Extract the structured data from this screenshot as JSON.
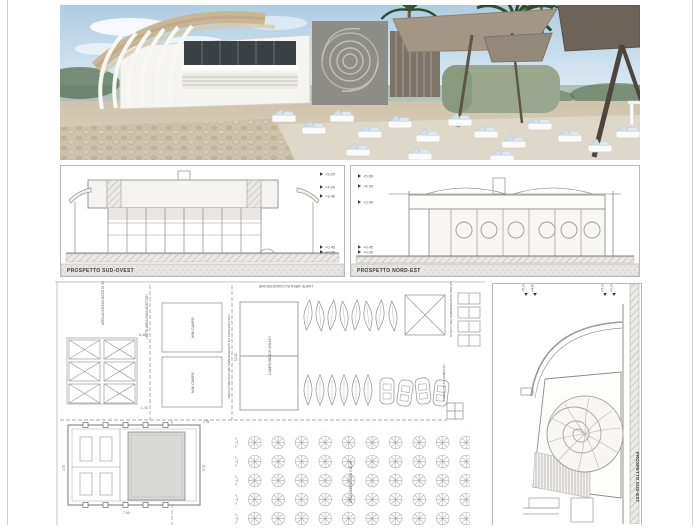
{
  "colors": {
    "linework": "#9a9a9a",
    "hatch": "#c8c8c8",
    "sky": "#b7d3e6",
    "sand": "#d0c5af",
    "umbrella": "#6e6358",
    "palm": "#2f4d2b",
    "cushion": "#d3e0ec",
    "roof_tan": "#c9b694",
    "green_wall": "#9aa78e"
  },
  "elevations": {
    "southwest": {
      "label": "PROSPETTO SUD-OVEST",
      "markers_top": [
        "+5.00",
        "+4.00",
        "+3.40"
      ],
      "markers_bottom": [
        "+0.45",
        "+0.00"
      ]
    },
    "northeast": {
      "label": "PROSPETTO NORD-EST",
      "markers_top": [
        "+5.00",
        "+4.50",
        "+3.40"
      ],
      "markers_bottom": [
        "+0.45",
        "+0.00"
      ]
    },
    "southeast": {
      "label": "PROSPETTO SUD-EST",
      "markers_left": [
        "+5.00",
        "+4.60"
      ],
      "markers_right": [
        "+5.00",
        "+0.00"
      ]
    }
  },
  "plan": {
    "labels": {
      "concession": "LIMITE AREA IN CONCESSIONE",
      "access": "AREA ACCESSO MEZZI DI SOCCORSO",
      "limit_left": "LIMITE AREA PIANI ADOTTATI",
      "mini_campo_1": "MINI CAMPO",
      "mini_campo_2": "MINI CAMPO",
      "equipment": "AREA ATTREZZATURE OMBREGGIANTI DA PIANI ADOTTATI",
      "volley": "CAMPO BEACH VOLLEY",
      "shade_structure": "STRUTTURA OMBREGGIANTE PER ATTIVITA' NAUTICHE",
      "lifeguard": "TORRETTA SALVAMENTO",
      "umbrellas": "AREA OMBRELLONI 5.00 ml",
      "limit_right": "LIMITE AREA PIANI ADOTTATI"
    },
    "dimensions": {
      "grid_width": "6.40",
      "grid_gap": "1.76",
      "volley_len": "12.45",
      "bldg_left": "4.75",
      "bldg_right": "0.75",
      "bldg_bottom": "7.00",
      "bldg_gap": "1.78"
    }
  }
}
